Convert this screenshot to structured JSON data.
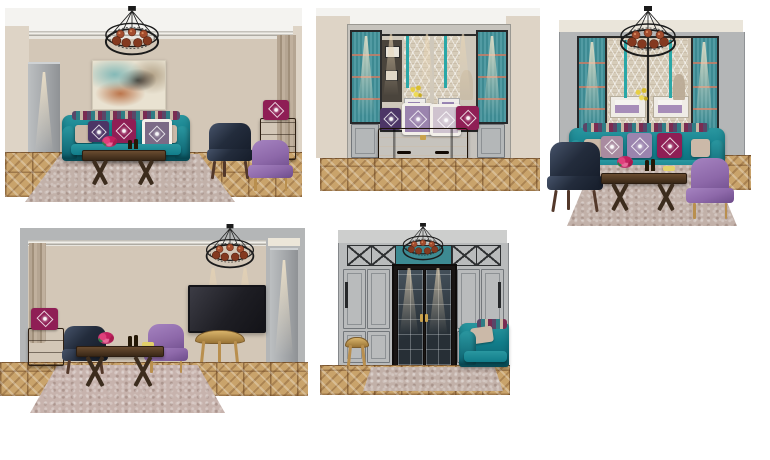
{
  "board": {
    "kind": "interior-design-elevation-board",
    "room": "living-room",
    "panel_count": 5
  },
  "panels": [
    {
      "name": "sofa-wall-elevation",
      "position": "top-left",
      "elements": [
        "chandelier",
        "abstract-painting",
        "teal-sofa",
        "medallion-pillows",
        "coffee-table",
        "flower-bouquet",
        "navy-leather-armchair",
        "drawer-chest",
        "magenta-pillow",
        "purple-slipper-chair",
        "pilaster",
        "curtain",
        "parquet-floor",
        "shag-rug"
      ]
    },
    {
      "name": "cabinet-and-mirror-elevation",
      "position": "top-center",
      "elements": [
        "glass-display-cabinet-left",
        "glass-display-cabinet-right",
        "mirror-with-reflection",
        "wood-trunk-dresser",
        "pillow-row",
        "light-beams",
        "parquet-floor"
      ]
    },
    {
      "name": "window-wall-elevation",
      "position": "top-right",
      "elements": [
        "chandelier",
        "lattice-curtains",
        "roman-shades",
        "teal-tassels",
        "glass-display-cabinets",
        "teal-sofa",
        "navy-leather-armchair",
        "purple-slipper-chair",
        "coffee-table",
        "flower-bouquet",
        "parquet-floor",
        "shag-rug"
      ]
    },
    {
      "name": "tv-wall-elevation",
      "position": "bottom-left",
      "elements": [
        "chandelier",
        "curtain",
        "wall-tv",
        "gold-console-table",
        "wood-trunk",
        "magenta-pillow",
        "navy-leather-armchair",
        "purple-slipper-chair",
        "coffee-table",
        "pilaster",
        "parquet-floor",
        "shag-rug"
      ]
    },
    {
      "name": "wardrobe-doors-elevation",
      "position": "bottom-center",
      "elements": [
        "chandelier",
        "paneled-wardrobe",
        "x-pattern-top-panels",
        "teal-transom",
        "glazed-double-doors",
        "gold-stool",
        "teal-sofa-corner",
        "parquet-floor",
        "shag-rug"
      ]
    }
  ],
  "palette": {
    "canvas_bg": "#ffffff",
    "wall": "#d3c7b7",
    "wall_side": "#ded4c6",
    "ceiling": "#f4f3f0",
    "gray_panel": "#b4b6b7",
    "wardrobe": "#b9bbbc",
    "curtain_taupe": "#b3a390",
    "lattice_curtain": "#d6ccb9",
    "glass_teal": "#3d8a92",
    "glass_teal_light": "#529ba3",
    "tassel_teal": "#2aa7a7",
    "sofa_teal": "#117d8a",
    "sofa_teal_dark": "#0b5f6d",
    "navy": "#232c3c",
    "purple": "#8d68a9",
    "plum": "#4c3566",
    "lavender": "#9b84ae",
    "magenta": "#8f1e55",
    "beige_pillow": "#cbb9a8",
    "wood": "#6b4a2e",
    "trunk": "#46301e",
    "gold": "#c29a55",
    "parquet": "#c9a36b",
    "rug": "#c2b1a9",
    "tv_screen": "#26262b",
    "door": "#231d1c",
    "door_glass": "#3a4750",
    "mirror": "#cfc8bb",
    "copper": "#a34d2e",
    "chandelier_frame": "#1b1b1b",
    "painting_teal": "#8fc2c0",
    "painting_rust": "#b05a2a",
    "flower_pink": "#d6336c",
    "flower_yellow": "#e4c93e"
  }
}
